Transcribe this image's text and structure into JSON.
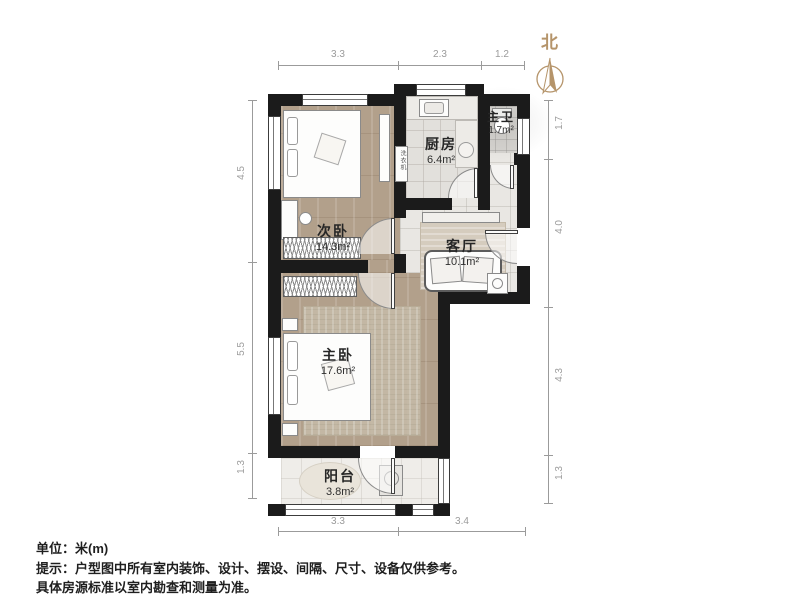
{
  "north": {
    "label": "北"
  },
  "rooms": [
    {
      "id": "secondary-bedroom",
      "name": "次卧",
      "area": "14.3m²"
    },
    {
      "id": "kitchen",
      "name": "厨房",
      "area": "6.4m²"
    },
    {
      "id": "master-bathroom",
      "name": "主卫",
      "area": "1.7m²"
    },
    {
      "id": "living-room",
      "name": "客厅",
      "area": "10.1m²"
    },
    {
      "id": "master-bedroom",
      "name": "主卧",
      "area": "17.6m²"
    },
    {
      "id": "balcony",
      "name": "阳台",
      "area": "3.8m²"
    }
  ],
  "dims": {
    "top": [
      "3.3",
      "2.3",
      "1.2"
    ],
    "bottom": [
      "3.3",
      "3.4"
    ],
    "left": [
      "4.5",
      "5.5",
      "1.3"
    ],
    "right": [
      "1.7",
      "4.0",
      "4.3",
      "1.3"
    ]
  },
  "appliances": {
    "washer": "洗衣机"
  },
  "notes": {
    "unit": "单位：米(m)",
    "tip": "提示：户型图中所有室内装饰、设计、摆设、间隔、尺寸、设备仅供参考。",
    "tip2": "具体房源标准以室内勘查和测量为准。"
  },
  "colors": {
    "wall": "#1b1b1b",
    "wood_floor": "#b2a08b",
    "tile_floor": "#e9e7e3",
    "north_accent": "#b5946a",
    "dim_text": "#9b9b9b"
  }
}
